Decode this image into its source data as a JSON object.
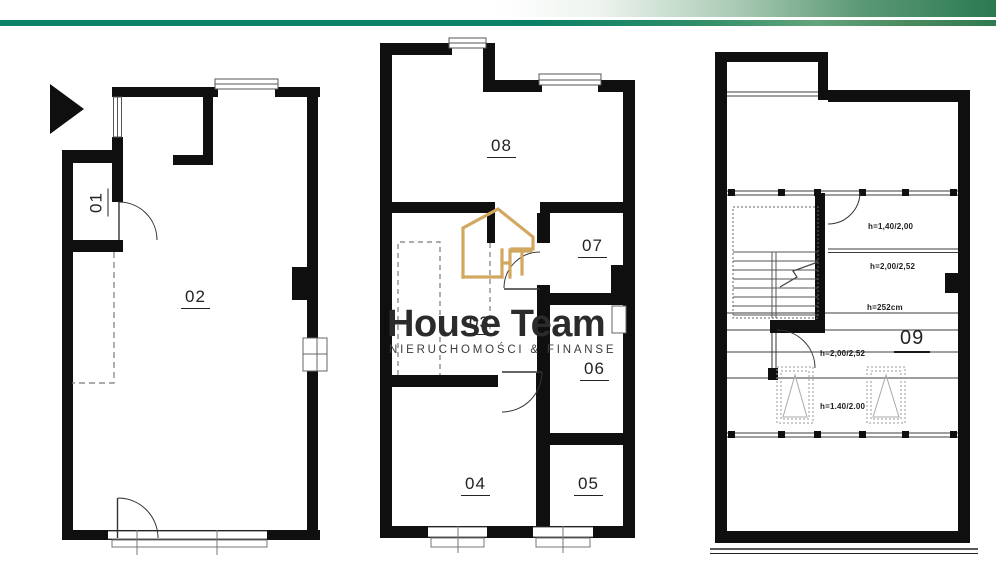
{
  "header": {
    "band_color": "#2b7a4f",
    "stripe_color": "#0a8066"
  },
  "watermark": {
    "title": "House Team",
    "subtitle": "NIERUCHOMOŚCI & FINANSE",
    "icon": "house-outline-icon",
    "accent_gold": "#d2a860"
  },
  "plans": {
    "left": "floor-plan-1",
    "middle": "floor-plan-2",
    "right": "floor-plan-attic"
  },
  "rooms": {
    "r01": "01",
    "r02": "02",
    "r03": "03",
    "r04": "04",
    "r05": "05",
    "r06": "06",
    "r07": "07",
    "r08": "08",
    "r09": "09"
  },
  "annotations": {
    "a1": "h=1,40/2,00",
    "a2": "h=2,00/2,52",
    "a3": "h=252cm",
    "a4": "h=2,00/2,52",
    "a5": "h=1.40/2.00"
  },
  "colors": {
    "wall": "#0f0f0f",
    "thin_line": "#3c3c3c",
    "dashed_line": "#7a7a7a"
  }
}
